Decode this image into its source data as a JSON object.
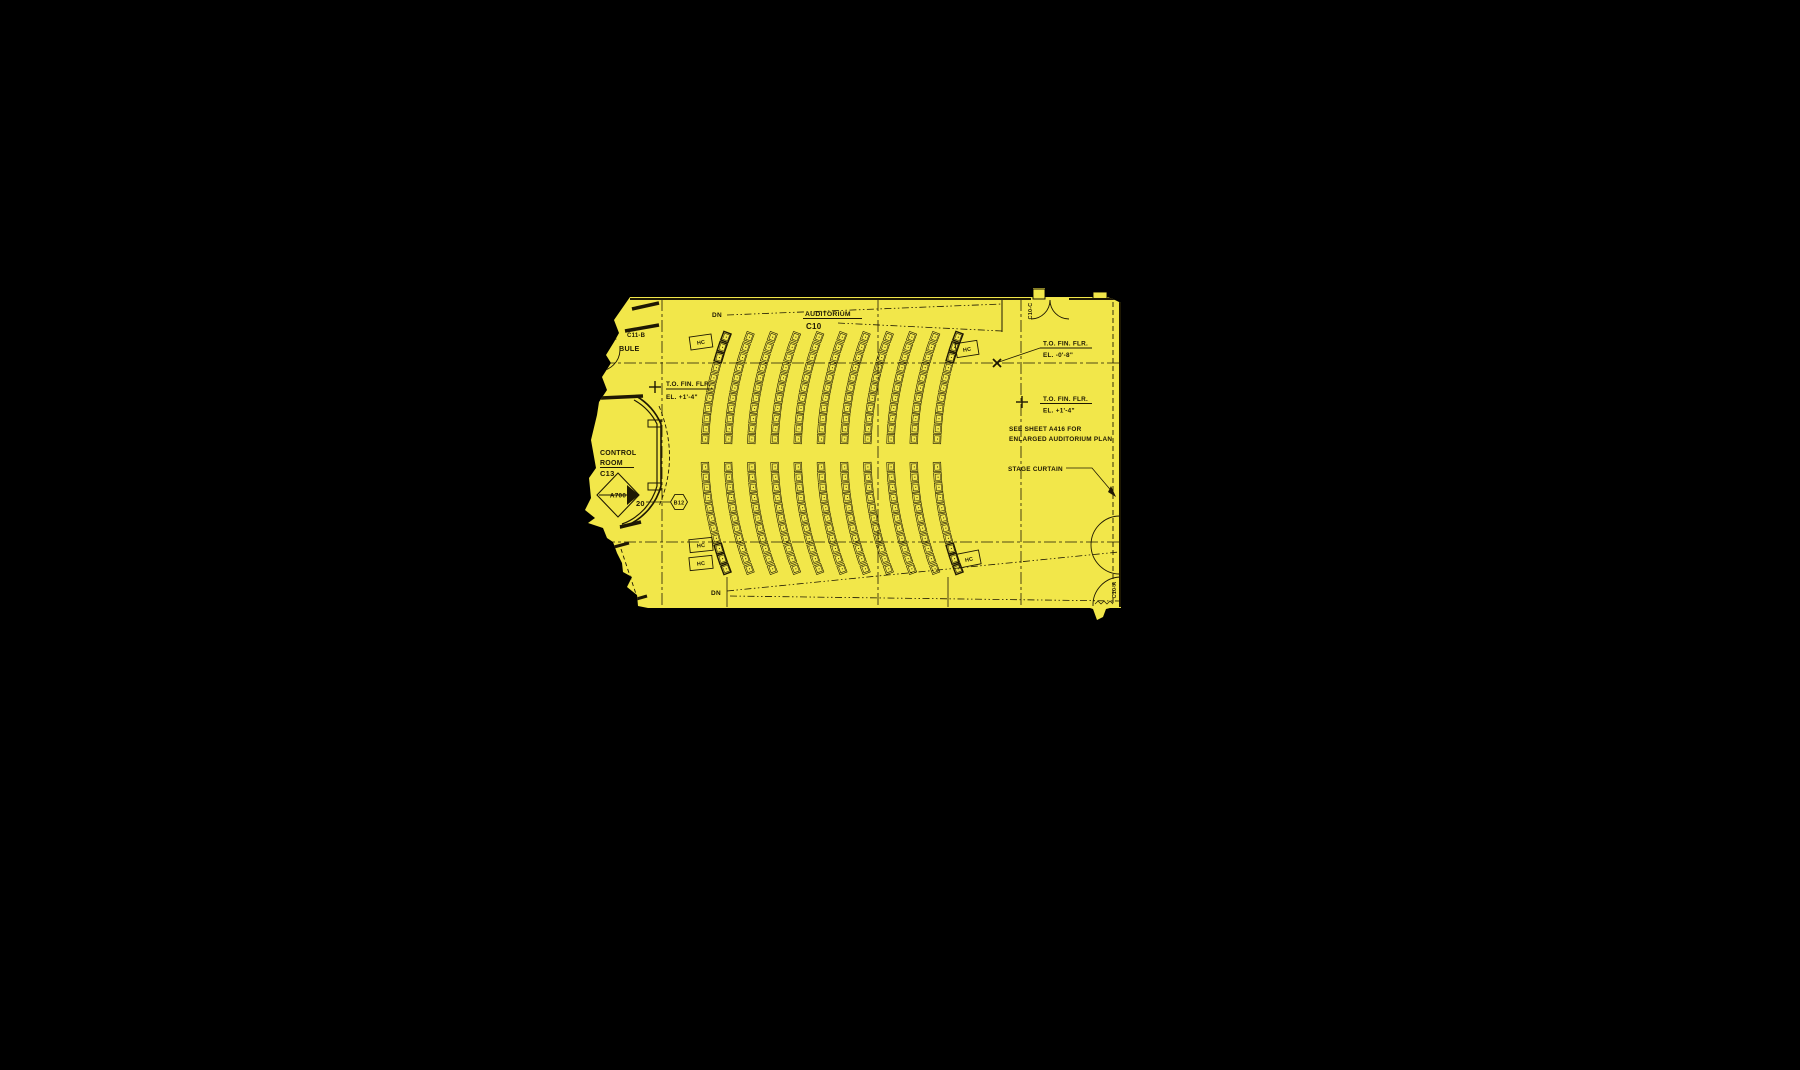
{
  "canvas": {
    "width": 1800,
    "height": 1070,
    "background": "#000000"
  },
  "plan": {
    "highlight_color": "#f2e74a",
    "ink_color": "#1e1803",
    "region": [
      [
        630,
        297
      ],
      [
        1031,
        297
      ],
      [
        1033,
        297
      ],
      [
        1033,
        288
      ],
      [
        1045,
        288
      ],
      [
        1045,
        297
      ],
      [
        1093,
        297
      ],
      [
        1093,
        292
      ],
      [
        1107,
        292
      ],
      [
        1107,
        297
      ],
      [
        1113,
        299
      ],
      [
        1121,
        303
      ],
      [
        1121,
        608
      ],
      [
        1110,
        608
      ],
      [
        1106,
        609
      ],
      [
        1103,
        617
      ],
      [
        1097,
        620
      ],
      [
        1093,
        609
      ],
      [
        1090,
        608
      ],
      [
        648,
        608
      ],
      [
        638,
        606
      ],
      [
        637,
        595
      ],
      [
        627,
        587
      ],
      [
        632,
        577
      ],
      [
        623,
        572
      ],
      [
        622,
        563
      ],
      [
        617,
        553
      ],
      [
        613,
        542
      ],
      [
        607,
        538
      ],
      [
        603,
        528
      ],
      [
        588,
        523
      ],
      [
        595,
        518
      ],
      [
        585,
        510
      ],
      [
        591,
        498
      ],
      [
        589,
        478
      ],
      [
        596,
        468
      ],
      [
        591,
        440
      ],
      [
        597,
        415
      ],
      [
        599,
        402
      ],
      [
        607,
        390
      ],
      [
        602,
        377
      ],
      [
        611,
        363
      ],
      [
        606,
        355
      ],
      [
        614,
        342
      ],
      [
        619,
        333
      ],
      [
        614,
        320
      ]
    ]
  },
  "grid": {
    "vertical": [
      662,
      878,
      1021
    ],
    "horizontal": [
      363,
      542
    ],
    "v_y1": 299,
    "v_y2": 608,
    "h_x1": 582,
    "h_x2": 1121,
    "dash": "12 3 3 3"
  },
  "stage_curtain_line": {
    "x": 1113,
    "y1": 302,
    "y2": 606,
    "dash": "5 3"
  },
  "sightlines": {
    "dash": "7 2.5 1.5 2.5 1.5 2.5",
    "lines": [
      [
        727,
        315,
        1002,
        304
      ],
      [
        838,
        323,
        1002,
        331
      ],
      [
        727,
        591,
        1119,
        552
      ],
      [
        730,
        596,
        1119,
        601
      ]
    ]
  },
  "walls": [
    {
      "name": "top-wall-left",
      "x1": 630,
      "y1": 299,
      "x2": 1031,
      "y2": 299,
      "w": 2
    },
    {
      "name": "top-wall-right",
      "x1": 1069,
      "y1": 299,
      "x2": 1121,
      "y2": 299,
      "w": 2
    },
    {
      "name": "right-wall",
      "x1": 1120,
      "y1": 300,
      "x2": 1120,
      "y2": 607,
      "w": 2
    },
    {
      "name": "wall-stub",
      "x1": 1002,
      "y1": 300,
      "x2": 1002,
      "y2": 332,
      "w": 1
    },
    {
      "name": "vestibule-wall-1",
      "x1": 632,
      "y1": 309,
      "x2": 659,
      "y2": 303,
      "w": 3.5
    },
    {
      "name": "vestibule-wall-2",
      "x1": 625,
      "y1": 331,
      "x2": 659,
      "y2": 325,
      "w": 3.5
    },
    {
      "name": "vestibule-stub",
      "x1": 604,
      "y1": 342,
      "x2": 616,
      "y2": 338,
      "w": 3
    },
    {
      "name": "control-top-wall",
      "x1": 601,
      "y1": 398,
      "x2": 643,
      "y2": 396,
      "w": 3.5
    },
    {
      "name": "control-bottom-wall",
      "x1": 620,
      "y1": 527,
      "x2": 641,
      "y2": 522,
      "w": 3.5
    },
    {
      "name": "stair-wall-1",
      "x1": 614,
      "y1": 547,
      "x2": 629,
      "y2": 543,
      "w": 3
    },
    {
      "name": "stair-wall-2",
      "x1": 633,
      "y1": 600,
      "x2": 647,
      "y2": 596,
      "w": 3
    },
    {
      "name": "aisle-edge-left",
      "x1": 727,
      "y1": 577,
      "x2": 727,
      "y2": 607,
      "w": 0.8
    },
    {
      "name": "aisle-edge-right",
      "x1": 948,
      "y1": 577,
      "x2": 948,
      "y2": 607,
      "w": 0.8
    }
  ],
  "dashed_walls": [
    {
      "name": "stair-hidden-line",
      "x1": 621,
      "y1": 549,
      "x2": 637,
      "y2": 597
    }
  ],
  "wall_rects": [
    {
      "name": "door-mullion-1",
      "x": 1033,
      "y": 289,
      "w": 12,
      "h": 10
    },
    {
      "name": "door-mullion-2",
      "x": 1093,
      "y": 292,
      "w": 14,
      "h": 7
    },
    {
      "name": "control-window-tab-1",
      "x": 648,
      "y": 420,
      "w": 13,
      "h": 7
    },
    {
      "name": "control-window-tab-2",
      "x": 648,
      "y": 483,
      "w": 13,
      "h": 7
    }
  ],
  "arc_paths": [
    {
      "name": "double-door-leaf-left",
      "d": "M 1050 300 A 19 19 0 0 1 1031 319",
      "w": 0.9
    },
    {
      "name": "double-door-leaf-right",
      "d": "M 1050 300 A 19 19 0 0 0 1069 319",
      "w": 0.9
    },
    {
      "name": "vestibule-door-swing",
      "d": "M 598 371 A 21.5 21.5 0 0 0 620 350",
      "w": 0.9
    },
    {
      "name": "right-door-swing-1",
      "d": "M 1120 516 A 29 29 0 0 0 1120 574",
      "w": 0.9
    },
    {
      "name": "right-door-swing-2",
      "d": "M 1120 577 A 28 28 0 0 0 1093 606",
      "w": 0.9
    },
    {
      "name": "control-wall-outer",
      "d": "M 636 396 A 60 60 0 0 1 661 424 L 661 486 A 60 60 0 0 1 620 528",
      "w": 1.6
    },
    {
      "name": "control-wall-inner",
      "d": "M 634 400 A 56 56 0 0 1 657 424 L 657 486 A 56 56 0 0 1 622 524",
      "w": 1.2
    },
    {
      "name": "threshold-hatch",
      "d": "M 1095 604 l 3 -3 l 3 3 l 3 -3 l 3 3 l 3 -3 l 3 3",
      "w": 0.7
    }
  ],
  "dashed_arcs": [
    {
      "name": "control-clearance-arc",
      "d": "M 659 406 Q 680 457 659 506",
      "dash": "4 2.5"
    }
  ],
  "seating": {
    "arc_count": 11,
    "x_start": 701,
    "x_step": 23.2,
    "radius": 330,
    "center_y": 453,
    "rows_top": {
      "y0": 337,
      "y1": 449,
      "step": 10.2
    },
    "rows_bottom": {
      "y0": 467,
      "y1": 569,
      "step": 10.2
    },
    "seat_w": 7.6,
    "seat_h": 9.2,
    "bold_arcs": [
      0,
      10
    ],
    "bold_end_count": 3
  },
  "hc_boxes": [
    {
      "label": "HC",
      "x": 701,
      "y": 342,
      "rot": -8,
      "w": 22,
      "h": 13
    },
    {
      "label": "HC",
      "x": 967,
      "y": 349,
      "rot": -9,
      "w": 22,
      "h": 14
    },
    {
      "label": "HC",
      "x": 701,
      "y": 545,
      "rot": -6,
      "w": 23,
      "h": 13
    },
    {
      "label": "HC",
      "x": 701,
      "y": 563,
      "rot": -6,
      "w": 23,
      "h": 13
    },
    {
      "label": "HC",
      "x": 969,
      "y": 559,
      "rot": -11,
      "w": 22,
      "h": 14
    }
  ],
  "markers": {
    "x_marker": {
      "x": 997,
      "y": 363
    },
    "plus_markers": [
      {
        "x": 655,
        "y": 387
      },
      {
        "x": 1022,
        "y": 402
      }
    ]
  },
  "underlines": [
    [
      803,
      318.5,
      862
    ],
    [
      600,
      467.5,
      634
    ],
    [
      666,
      389,
      713
    ],
    [
      1040,
      348,
      1092
    ],
    [
      1040,
      403.5,
      1092
    ]
  ],
  "leaders": [
    {
      "name": "elevation-leader",
      "d": "M 1040 348 L 999 362"
    },
    {
      "name": "b12-leader",
      "d": "M 646 502 L 670 502"
    },
    {
      "name": "stage-curtain-leader",
      "d": "M 1066 468 L 1092 468 L 1114 494"
    }
  ],
  "arrowhead": {
    "points": [
      [
        1116,
        497
      ],
      [
        1108,
        492
      ],
      [
        1111,
        486
      ]
    ]
  },
  "detail_marker": {
    "diamond": [
      [
        597,
        495
      ],
      [
        618,
        473
      ],
      [
        639,
        495
      ],
      [
        618,
        517
      ]
    ],
    "filled_quadrant": [
      [
        627,
        485
      ],
      [
        639,
        495
      ],
      [
        627,
        505
      ]
    ],
    "divider": [
      599,
      495,
      637,
      495
    ]
  },
  "hexagon": {
    "cx": 679,
    "cy": 502,
    "r": 8.5
  },
  "labels": [
    {
      "id": "dn-top-label",
      "text": "DN",
      "x": 712,
      "y": 317,
      "size": 6.5
    },
    {
      "id": "auditorium-room-name",
      "text": "AUDITORIUM",
      "x": 805,
      "y": 316,
      "size": 6.8
    },
    {
      "id": "auditorium-room-number",
      "text": "C10",
      "x": 806,
      "y": 329,
      "size": 8
    },
    {
      "id": "room-number-c11b",
      "text": "C11-B",
      "x": 627,
      "y": 337,
      "size": 6
    },
    {
      "id": "vestibule-partial-label",
      "text": "BULE",
      "x": 619,
      "y": 351,
      "size": 7.2
    },
    {
      "id": "elev-left-line1",
      "text": "T.O. FIN. FLR.",
      "x": 666,
      "y": 386,
      "size": 6.4
    },
    {
      "id": "elev-left-line2",
      "text": "EL. +1'-4\"",
      "x": 666,
      "y": 399,
      "size": 6.4
    },
    {
      "id": "control-room-name-1",
      "text": "CONTROL",
      "x": 600,
      "y": 455,
      "size": 7
    },
    {
      "id": "control-room-name-2",
      "text": "ROOM",
      "x": 600,
      "y": 465,
      "size": 7
    },
    {
      "id": "control-room-number",
      "text": "C13",
      "x": 600,
      "y": 476,
      "size": 7.5
    },
    {
      "id": "detail-callout-a700",
      "text": "A700",
      "x": 618,
      "y": 497.5,
      "size": 6.4,
      "anchor": "middle"
    },
    {
      "id": "detail-callout-20",
      "text": "20",
      "x": 636,
      "y": 506,
      "size": 7.5
    },
    {
      "id": "keynote-b12",
      "text": "B12",
      "x": 679,
      "y": 504.5,
      "size": 5.4,
      "anchor": "middle"
    },
    {
      "id": "elev-right1-line1",
      "text": "T.O. FIN. FLR.",
      "x": 1043,
      "y": 345.5,
      "size": 6.4
    },
    {
      "id": "elev-right1-line2",
      "text": "EL. -0'-8\"",
      "x": 1043,
      "y": 357,
      "size": 6.4
    },
    {
      "id": "elev-right2-line1",
      "text": "T.O. FIN. FLR.",
      "x": 1043,
      "y": 401,
      "size": 6.4
    },
    {
      "id": "elev-right2-line2",
      "text": "EL. +1'-4\"",
      "x": 1043,
      "y": 412.5,
      "size": 6.4
    },
    {
      "id": "see-sheet-note-1",
      "text": "SEE SHEET A416 FOR",
      "x": 1009,
      "y": 431,
      "size": 6.4
    },
    {
      "id": "see-sheet-note-2",
      "text": "ENLARGED AUDITORIUM PLAN",
      "x": 1009,
      "y": 441,
      "size": 6.4
    },
    {
      "id": "stage-curtain-label",
      "text": "STAGE CURTAIN",
      "x": 1008,
      "y": 471,
      "size": 6.4
    },
    {
      "id": "door-tag-c10c",
      "text": "C10-C",
      "x": 1032,
      "y": 311,
      "size": 5.4,
      "rot": -90,
      "anchor": "middle"
    },
    {
      "id": "door-tag-c10a",
      "text": "C10-A",
      "x": 1116,
      "y": 590,
      "size": 5.4,
      "rot": -90,
      "anchor": "middle"
    },
    {
      "id": "dn-bottom-label",
      "text": "DN",
      "x": 711,
      "y": 595,
      "size": 6.5
    }
  ]
}
